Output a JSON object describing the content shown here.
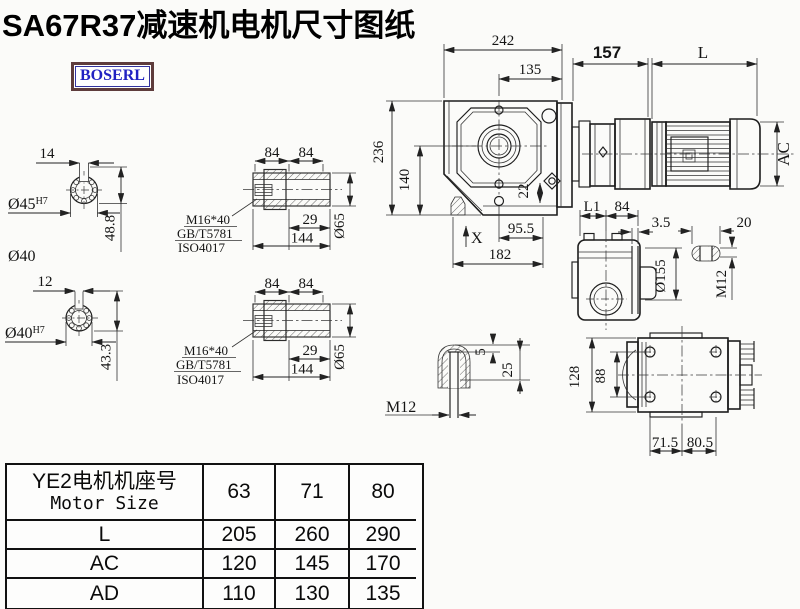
{
  "title": "SA67R37减速机电机尺寸图纸",
  "logo": "BOSERL",
  "colors": {
    "line": "#1d1d1d",
    "logo_text": "#2121c2",
    "logo_border": "#5e3c3c",
    "background": "#fbfbf9"
  },
  "shaft45": {
    "key_width": "14",
    "dia": "Ø45",
    "fit": "H7",
    "height": "48.8",
    "extra": "Ø40"
  },
  "shaft40": {
    "key_width": "12",
    "dia": "Ø40",
    "fit": "H7",
    "height": "43.3"
  },
  "hollow1": {
    "d84a": "84",
    "d84b": "84",
    "bolt": "M16*40",
    "std1": "GB/T5781",
    "std2": "ISO4017",
    "d29": "29",
    "d144": "144",
    "dia": "Ø65"
  },
  "hollow2": {
    "d84a": "84",
    "d84b": "84",
    "bolt": "M16*40",
    "std1": "GB/T5781",
    "std2": "ISO4017",
    "d29": "29",
    "d144": "144",
    "dia": "Ø65"
  },
  "front": {
    "w242": "242",
    "w135": "135",
    "w157": "157",
    "motor_len": "L",
    "h236": "236",
    "h140": "140",
    "d22": "22",
    "d955": "95.5",
    "d182": "182",
    "x": "X",
    "ac": "AC"
  },
  "side": {
    "l1": "L1",
    "d84": "84",
    "d35": "3.5",
    "d20": "20",
    "dia155": "Ø155",
    "m12": "M12"
  },
  "bottom": {
    "d128": "128",
    "d88": "88",
    "d715": "71.5",
    "d805": "80.5"
  },
  "detail": {
    "d5": "5",
    "d25": "25",
    "m12": "M12"
  },
  "table": {
    "header_cn": "YE2电机机座号",
    "header_en": "Motor Size",
    "cols": [
      "63",
      "71",
      "80"
    ],
    "rows": [
      {
        "l": "L",
        "v": [
          "205",
          "260",
          "290"
        ]
      },
      {
        "l": "AC",
        "v": [
          "120",
          "145",
          "170"
        ]
      },
      {
        "l": "AD",
        "v": [
          "110",
          "130",
          "135"
        ]
      }
    ]
  }
}
